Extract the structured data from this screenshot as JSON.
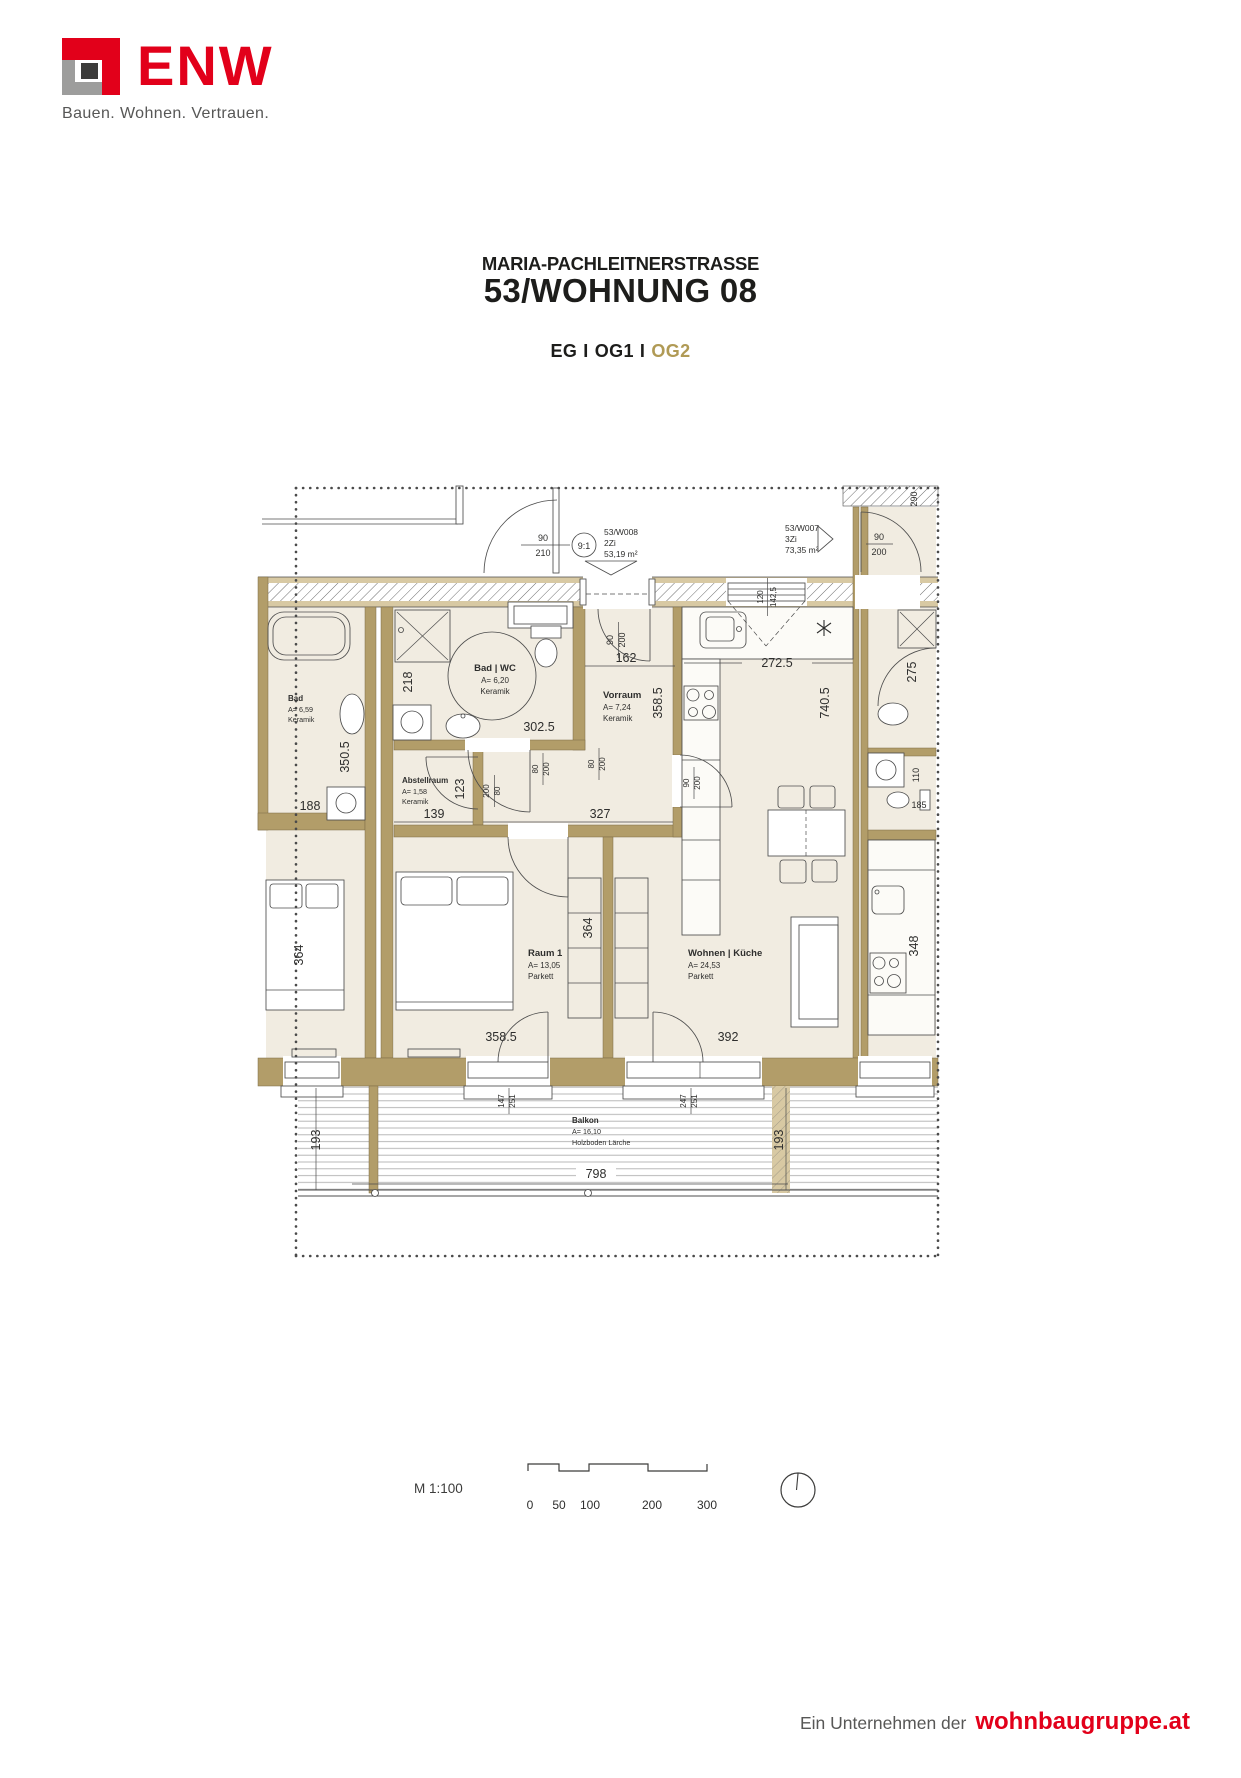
{
  "header": {
    "logo_text": "ENW",
    "tagline": "Bauen. Wohnen. Vertrauen.",
    "title_line1": "MARIA-PACHLEITNERSTRASSE",
    "title_line2": "53/WOHNUNG 08",
    "floors": {
      "eg": "EG",
      "sep": "I",
      "og1": "OG1",
      "og2": "OG2"
    }
  },
  "theme": {
    "brand_red": "#e2001a",
    "active_gold": "#b09a55",
    "wall_tan": "#b29d69"
  },
  "plan": {
    "units": {
      "w008": {
        "id": "53/W008",
        "size": "2Zi",
        "area": "53,19 m²"
      },
      "w007": {
        "id": "53/W007",
        "size": "3Zi",
        "area": "73,35 m²"
      }
    },
    "stair_ref": "9:1",
    "rooms": {
      "badwc": {
        "name": "Bad | WC",
        "area": "A= 6,20",
        "floor": "Keramik"
      },
      "vorraum": {
        "name": "Vorraum",
        "area": "A= 7,24",
        "floor": "Keramik"
      },
      "abstell": {
        "name": "Abstellraum",
        "area": "A= 1,58",
        "floor": "Keramik"
      },
      "raum1": {
        "name": "Raum 1",
        "area": "A= 13,05",
        "floor": "Parkett"
      },
      "wohnen": {
        "name": "Wohnen | Küche",
        "area": "A= 24,53",
        "floor": "Parkett"
      },
      "balkon": {
        "name": "Balkon",
        "area": "A= 16,10",
        "floor": "Holzboden Lärche"
      },
      "nb_bad": {
        "name": "Bad",
        "area": "A= 6,59",
        "floor": "Keramik"
      }
    },
    "dims": {
      "stair_door": {
        "w": "90",
        "h": "210"
      },
      "entry_door": {
        "w": "90",
        "h": "200"
      },
      "kitchen_window": {
        "a": "120",
        "b": "142,5"
      },
      "vorraum_width": "162",
      "kitchen_width": "272.5",
      "vorraum_length": "358.5",
      "apartment_depth": "740.5",
      "badwc_height": "218",
      "badwc_width": "302.5",
      "badwc_door": {
        "w": "80",
        "h": "200"
      },
      "abstell_door": {
        "w": "200",
        "h": "80"
      },
      "raum1_door": {
        "w": "80",
        "h": "200"
      },
      "wohnen_door": {
        "w": "90",
        "h": "200"
      },
      "corridor_width": "327",
      "abstell_width": "139",
      "abstell_height": "123",
      "wardrobe_depth": "364",
      "nb_left_room": "364",
      "raum1_width": "358.5",
      "wohnen_width": "392",
      "nb_bad_length": "350.5",
      "nb_bad_width": "188",
      "nb_shower": "275",
      "nb_wc": "185",
      "nb_wc_depth": "110",
      "nb_top": "290",
      "nb_kitchen": "348",
      "nb_door": {
        "w": "90",
        "h": "200"
      },
      "balcony_door1": {
        "a": "147",
        "b": "251"
      },
      "balcony_door2": {
        "a": "247",
        "b": "251"
      },
      "balcony_depth_left": "193",
      "balcony_depth_right": "193",
      "balcony_width": "798"
    }
  },
  "legend": {
    "scale_label": "M 1:100",
    "ticks": [
      "0",
      "50",
      "100",
      "200",
      "300"
    ]
  },
  "footer": {
    "prefix": "Ein Unternehmen der",
    "brand": "wohnbaugruppe.at"
  }
}
